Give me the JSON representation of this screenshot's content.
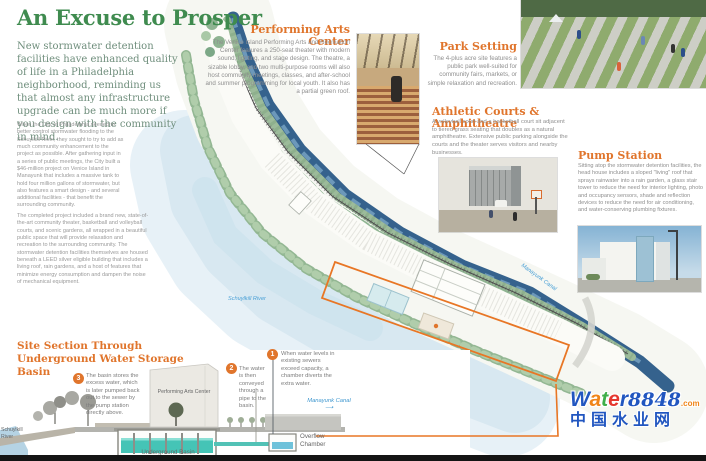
{
  "page": {
    "title": "An Excuse to Prosper",
    "intro": "New stormwater detention facilities have enhanced quality of life in a Philadelphia neighborhood, reminding us that almost any infrastructure upgrade can be much more if you design with the community in mind.",
    "body_p1": "When the City of Philadelphia needed to better control stormwater flooding to the Schuylkill River, they sought to try to add as much community enhancement to the project as possible. After gathering input in a series of public meetings, the City built a $46-million project on Venice Island in Manayunk that includes a massive tank to hold four million gallons of stormwater, but also features a smart design - and several additional facilities - that benefit the surrounding community.",
    "body_p2": "The completed project included a brand new, state-of-the-art community theater, basketball and volleyball courts, and scenic gardens, all wrapped in a beautiful public space that will provide relaxation and recreation to the surrounding community. The stormwater detention facilities themselves are housed beneath a LEED silver eligible building that includes a living roof, rain gardens, and a host of features that minimize energy consumption and dampen the noise of mechanical equipment."
  },
  "features": {
    "performing_arts": {
      "title": "Performing Arts Center",
      "text": "The Venice Island Performing Arts and Recreation Center features a 250-seat theater with modern sound, lighting, and stage design. The theatre, a sizable lobby, and two multi-purpose rooms will also host community meetings, classes, and after-school and summer programming for local youth. It also has a partial green roof."
    },
    "park_setting": {
      "title": "Park Setting",
      "text": "The 4-plus acre site features a public park well-suited for community fairs, markets, or simple relaxation and recreation."
    },
    "athletic": {
      "title": "Athletic Courts & Amphitheatre",
      "text": "A volleyball court and a basketball court sit adjacent to tiered grass seating that doubles as a natural amphitheatre. Extensive public parking alongside the courts and the theater serves visitors and nearby businesses."
    },
    "pump_station": {
      "title": "Pump Station",
      "text": "Sitting atop the stormwater detention facilities, the head house includes a sloped \"living\" roof that sprays rainwater into a rain garden, a glass stair tower to reduce the need for interior lighting, photo and occupancy sensors, shade and reflection devices to reduce the need for air conditioning, and water-conserving plumbing fixtures."
    }
  },
  "section_diagram": {
    "title": "Site Section Through Underground Water Storage Basin",
    "steps": [
      {
        "num": "1",
        "text": "When water levels in existing sewers exceed capacity, a chamber diverts the extra water."
      },
      {
        "num": "2",
        "text": "The water is then conveyed through a pipe to the basin."
      },
      {
        "num": "3",
        "text": "The basin stores the excess water, which is later pumped back out to the sewer by the pump station directly above."
      }
    ],
    "labels": {
      "schuylkill": "Schuylkill River",
      "pac": "Performing Arts Center",
      "canal": "Manayunk Canal",
      "canal_arrow": "⟶",
      "overflow": "Overflow Chamber",
      "basin": "Underground Basin"
    }
  },
  "map": {
    "labels": {
      "river": "Schuylkill River",
      "canal": "Manayunk Canal"
    }
  },
  "watermark": {
    "letters": [
      "W",
      "a",
      "t",
      "e",
      "r"
    ],
    "num": "8848",
    "dotcom": ".com",
    "chinese": "中国水业网"
  },
  "colors": {
    "title_green": "#3f8b4f",
    "heading_orange": "#e0752c",
    "canal_blue": "#35628d",
    "river_wash": "#d8e8f1",
    "basin_teal": "#45c4b6",
    "label_blue": "#3e97cf"
  }
}
